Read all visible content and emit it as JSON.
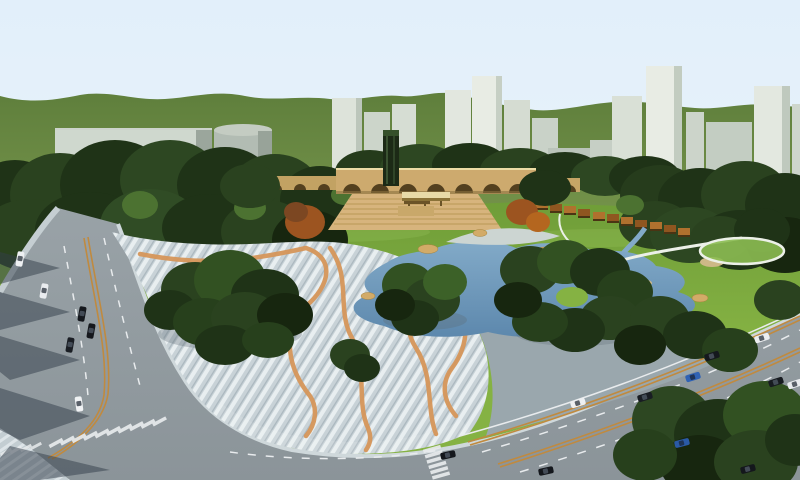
{
  "scene": {
    "kind": "architectural-3d-rendering",
    "subject": "aerial perspective of an urban park master plan",
    "elements": "sky, green hills, city towers, tree groves, central arched wall with amphitheater steps and dark tower, orange pergola colonnade, pond with rock and sand edges, striped pedestrian plaza with wavy orange paths, curving boulevard with traffic, crosswalks, tree shadows"
  },
  "inventory": {
    "cars_visible": 17,
    "building_towers": 13,
    "wall_arches": 7,
    "pergola_segments": 12,
    "crosswalks": 3,
    "ponds": 1,
    "orange_plaza_paths": 4
  },
  "palette": {
    "sky_top": "#e2effa",
    "sky_horizon": "#eef7fc",
    "hill_far": "#5f7f3c",
    "hill_near": "#7d9b50",
    "lawn_light": "#85b243",
    "lawn_dark": "#6f9d38",
    "lawn_highlight": "#9cc95e",
    "tree_dark": "#1f3317",
    "tree_mid": "#2a421f",
    "tree_deep": "#17260f",
    "tree_light": "#4c7231",
    "autumn_tree": "#9c5420",
    "water_light": "#82aac8",
    "water_dark": "#5d88ad",
    "plaza_base": "#c8d2d7",
    "plaza_stripe": "#e8eef0",
    "pavement": "#9aa7ad",
    "path_orange": "#d6965a",
    "road": "#8b9499",
    "marking_white": "#e8ebed",
    "marking_orange": "#c08a3f",
    "sidewalk": "#cfd8db",
    "wall_tan": "#cdaa6e",
    "wall_coping": "#ecdca6",
    "steps_tan": "#d7b47d",
    "arch_dark": "#53401f",
    "pergola_orange": "#b0712e",
    "pergola_dark": "#8f5620",
    "tower_dark": "#1c2a16",
    "building_light": "#e8ece4",
    "building_mid": "#cfd8ce",
    "building_shade": "#9ba69c",
    "rock_sand": "#d2ab68",
    "beach_gray": "#ccd5d2",
    "shadow": "#333e4a",
    "footpath_white": "#ecf0e8"
  },
  "cars": [
    {
      "color": "#eef0f2"
    },
    {
      "color": "#e9ecef"
    },
    {
      "color": "#15181d"
    },
    {
      "color": "#15181d"
    },
    {
      "color": "#1a1e24"
    },
    {
      "color": "#f0f2f4"
    },
    {
      "color": "#14171c"
    },
    {
      "color": "#14171c"
    },
    {
      "color": "#eef0f2"
    },
    {
      "color": "#191d23"
    },
    {
      "color": "#2a5aa6"
    },
    {
      "color": "#2f62b4"
    },
    {
      "color": "#15181d"
    },
    {
      "color": "#eceef0"
    },
    {
      "color": "#171b20"
    },
    {
      "color": "#14171c"
    },
    {
      "color": "#e8ebee"
    }
  ]
}
